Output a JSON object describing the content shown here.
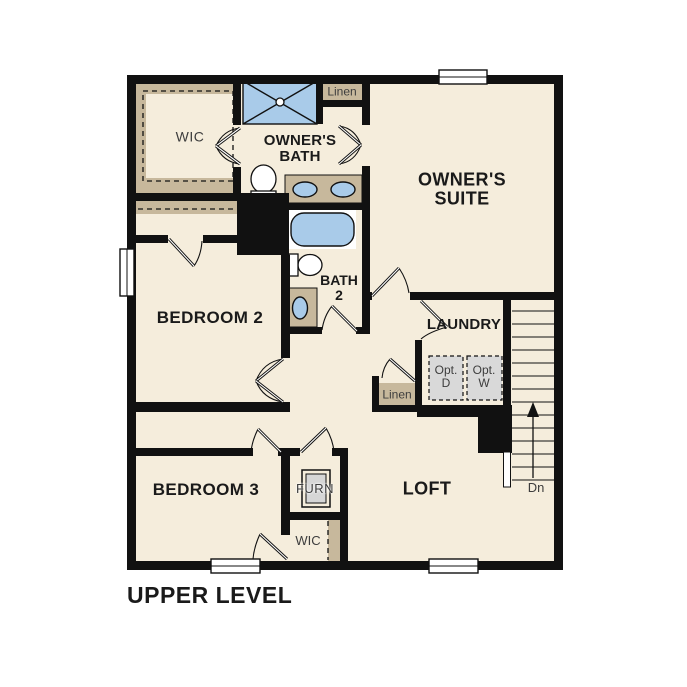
{
  "title": "UPPER LEVEL",
  "colors": {
    "floor": "#f5eddc",
    "casework_tan": "#c7b89c",
    "wall": "#111111",
    "fixture_blue": "#a9cbe9",
    "optional_gray": "#d9d9d9",
    "label_dark": "#1a1a1a",
    "label_gray": "#3d3d3d"
  },
  "labels": {
    "wic_upper": "WIC",
    "owners_bath": [
      "OWNER'S",
      "BATH"
    ],
    "linen_top": "Linen",
    "owners_suite": [
      "OWNER'S",
      "SUITE"
    ],
    "bedroom2": "BEDROOM 2",
    "bath2": [
      "BATH",
      "2"
    ],
    "laundry": "LAUNDRY",
    "opt_dryer": [
      "Opt.",
      "D"
    ],
    "opt_washer": [
      "Opt.",
      "W"
    ],
    "linen_hall": "Linen",
    "bedroom3": "BEDROOM 3",
    "furnace": "FURN",
    "loft": "LOFT",
    "wic_lower": "WIC",
    "stairs_down": "Dn"
  }
}
